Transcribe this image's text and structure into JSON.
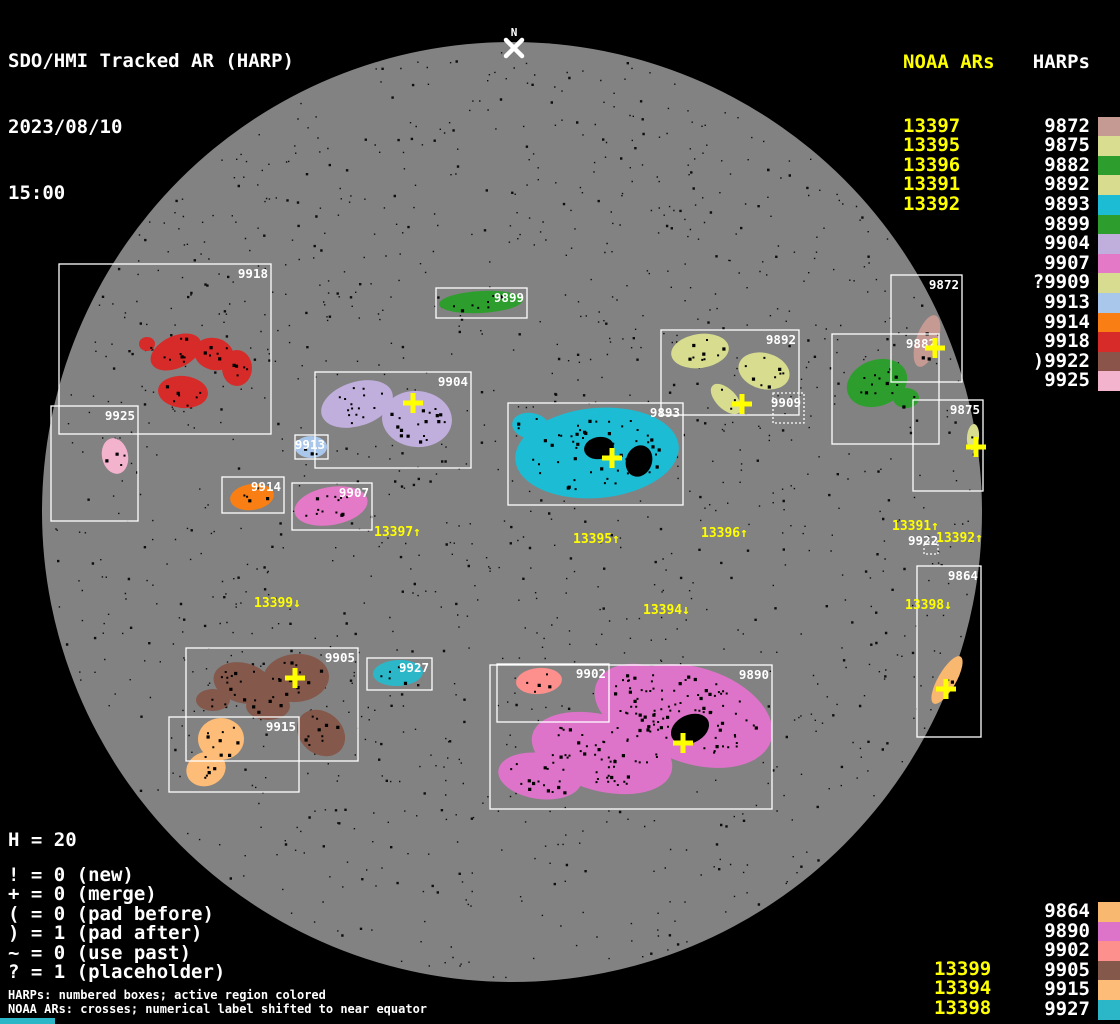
{
  "header": {
    "title": "SDO/HMI Tracked AR (HARP)",
    "date": "2023/08/10",
    "time": "15:00"
  },
  "north_marker": {
    "label": "N",
    "x": 514,
    "label_y": 36,
    "cross_x": 514,
    "cross_y": 48
  },
  "colors": {
    "background": "#000000",
    "disk": "#828282",
    "speckle": "#0d0d0d",
    "box_stroke": "#ffffff",
    "noaa_text": "#ffff00",
    "harp_text": "#ffffff",
    "cross": "#ffff00",
    "bottom_bar": "#2cb7c8"
  },
  "top_right": {
    "noaa_header": "NOAA ARs",
    "noaa_items": [
      "13397",
      "13395",
      "13396",
      "13391",
      "13392"
    ],
    "harps_header": "HARPs",
    "harp_items": [
      {
        "label": "9872",
        "color": "#c49a93"
      },
      {
        "label": "9875",
        "color": "#d9dd90"
      },
      {
        "label": "9882",
        "color": "#2d9e2d"
      },
      {
        "label": "9892",
        "color": "#d7dc8f"
      },
      {
        "label": "9893",
        "color": "#1cbcd4"
      },
      {
        "label": "9899",
        "color": "#2d9e2d"
      },
      {
        "label": "9904",
        "color": "#c0aedd"
      },
      {
        "label": "9907",
        "color": "#e379c7"
      },
      {
        "label": "?9909",
        "color": "#d8dc90"
      },
      {
        "label": "9913",
        "color": "#a9c7ea"
      },
      {
        "label": "9914",
        "color": "#f97f14"
      },
      {
        "label": "9918",
        "color": "#d62b28"
      },
      {
        "label": ")9922",
        "color": "#8b544a"
      },
      {
        "label": "9925",
        "color": "#f4b3cd"
      }
    ]
  },
  "bottom_right": {
    "noaa_items": [
      "13399",
      "13394",
      "13398"
    ],
    "harp_items": [
      {
        "label": "9864",
        "color": "#f9b870"
      },
      {
        "label": "9890",
        "color": "#dd74c9"
      },
      {
        "label": "9902",
        "color": "#fd8f8d"
      },
      {
        "label": "9905",
        "color": "#84584a"
      },
      {
        "label": "9915",
        "color": "#fdbc77"
      },
      {
        "label": "9927",
        "color": "#2cb7c8"
      }
    ]
  },
  "stats": {
    "h_count": "H = 20",
    "legend": [
      "! = 0 (new)",
      "+ = 0 (merge)",
      "( = 0 (pad before)",
      ") = 1 (pad after)",
      "~ = 0 (use past)",
      "? = 1 (placeholder)"
    ]
  },
  "footnotes": [
    "HARPs: numbered boxes; active region colored",
    "NOAA ARs: crosses; numerical label shifted to near equator"
  ],
  "chart_data": {
    "type": "solar-disk-map",
    "title": "SDO/HMI Tracked AR (HARP)",
    "timestamp": "2023/08/10 15:00",
    "disk": {
      "cx": 512,
      "cy": 512,
      "r": 470
    },
    "regions": [
      {
        "id": "9918",
        "color": "#d62b28",
        "box": [
          59,
          264,
          212,
          170
        ],
        "blobs": [
          [
            176,
            352,
            27,
            16,
            -25
          ],
          [
            214,
            354,
            20,
            16,
            15
          ],
          [
            237,
            368,
            15,
            18,
            0
          ],
          [
            183,
            392,
            25,
            16,
            5
          ],
          [
            147,
            344,
            8,
            7,
            0
          ]
        ]
      },
      {
        "id": "9925",
        "color": "#f4b3cd",
        "box": [
          51,
          406,
          87,
          115
        ],
        "blobs": [
          [
            115,
            456,
            13,
            18,
            -12
          ]
        ]
      },
      {
        "id": "9904",
        "color": "#c0aedd",
        "box": [
          315,
          372,
          156,
          96
        ],
        "blobs": [
          [
            357,
            404,
            37,
            22,
            -18
          ],
          [
            417,
            419,
            35,
            28,
            5
          ]
        ]
      },
      {
        "id": "9913",
        "color": "#a9c7ea",
        "box": [
          295,
          435,
          33,
          24
        ],
        "blobs": [
          [
            311,
            447,
            16,
            11,
            0
          ]
        ]
      },
      {
        "id": "9914",
        "color": "#f97f14",
        "box": [
          222,
          477,
          62,
          36
        ],
        "blobs": [
          [
            252,
            497,
            22,
            13,
            -8
          ]
        ]
      },
      {
        "id": "9907",
        "color": "#e379c7",
        "box": [
          292,
          483,
          80,
          47
        ],
        "blobs": [
          [
            331,
            506,
            37,
            19,
            -10
          ]
        ]
      },
      {
        "id": "9899",
        "color": "#2d9e2d",
        "box": [
          436,
          288,
          91,
          30
        ],
        "blobs": [
          [
            481,
            302,
            42,
            11,
            -3
          ]
        ]
      },
      {
        "id": "9893",
        "color": "#1cbcd4",
        "box": [
          508,
          403,
          175,
          102
        ],
        "blobs": [
          [
            597,
            453,
            82,
            45,
            -5
          ],
          [
            531,
            426,
            19,
            13,
            10
          ]
        ],
        "dark": [
          [
            599,
            448,
            15,
            11,
            -10
          ],
          [
            639,
            461,
            13,
            16,
            20
          ]
        ]
      },
      {
        "id": "9892",
        "color": "#d7dc8f",
        "box": [
          661,
          330,
          138,
          85
        ],
        "blobs": [
          [
            700,
            351,
            29,
            17,
            -8
          ],
          [
            764,
            371,
            26,
            18,
            15
          ],
          [
            726,
            399,
            19,
            10,
            45
          ]
        ]
      },
      {
        "id": "9909",
        "color": "#d8dc90",
        "box": [
          773,
          393,
          31,
          30
        ],
        "box_style": "dotted",
        "blobs": []
      },
      {
        "id": "9882",
        "color": "#2d9e2d",
        "box": [
          832,
          334,
          107,
          110
        ],
        "blobs": [
          [
            877,
            383,
            31,
            23,
            -20
          ],
          [
            906,
            398,
            13,
            10,
            0
          ]
        ]
      },
      {
        "id": "9872",
        "color": "#c49a93",
        "box": [
          891,
          275,
          71,
          107
        ],
        "blobs": [
          [
            927,
            341,
            11,
            27,
            18
          ]
        ]
      },
      {
        "id": "9875",
        "color": "#d9dd90",
        "box": [
          913,
          400,
          70,
          91
        ],
        "blobs": [
          [
            973,
            437,
            6,
            13,
            5
          ]
        ]
      },
      {
        "id": "9864",
        "color": "#f9b870",
        "box": [
          917,
          566,
          64,
          171
        ],
        "blobs": [
          [
            947,
            680,
            9,
            27,
            30
          ]
        ]
      },
      {
        "id": "9905",
        "color": "#84584a",
        "box": [
          186,
          648,
          172,
          113
        ],
        "blobs": [
          [
            243,
            683,
            30,
            20,
            15
          ],
          [
            296,
            678,
            33,
            24,
            -5
          ],
          [
            321,
            733,
            26,
            21,
            40
          ],
          [
            213,
            700,
            17,
            11,
            0
          ],
          [
            268,
            706,
            22,
            14,
            0
          ]
        ]
      },
      {
        "id": "9915",
        "color": "#fdbc77",
        "box": [
          169,
          717,
          130,
          75
        ],
        "blobs": [
          [
            221,
            739,
            23,
            21,
            0
          ],
          [
            206,
            769,
            20,
            17,
            -20
          ]
        ]
      },
      {
        "id": "9927",
        "color": "#2cb7c8",
        "box": [
          367,
          658,
          65,
          32
        ],
        "blobs": [
          [
            398,
            673,
            25,
            13,
            -3
          ]
        ]
      },
      {
        "id": "9902",
        "color": "#fd8f8d",
        "box": [
          497,
          664,
          112,
          58
        ],
        "blobs": [
          [
            539,
            681,
            23,
            13,
            -5
          ]
        ]
      },
      {
        "id": "9890",
        "color": "#dd74c9",
        "box": [
          490,
          665,
          282,
          144
        ],
        "blobs": [
          [
            695,
            716,
            80,
            48,
            18
          ],
          [
            602,
            753,
            72,
            38,
            15
          ],
          [
            540,
            776,
            42,
            23,
            8
          ],
          [
            645,
            702,
            52,
            36,
            20
          ]
        ],
        "dark": [
          [
            690,
            729,
            20,
            14,
            -25
          ]
        ]
      }
    ],
    "crosses": [
      {
        "x": 413,
        "y": 403
      },
      {
        "x": 742,
        "y": 404
      },
      {
        "x": 612,
        "y": 458
      },
      {
        "x": 935,
        "y": 348
      },
      {
        "x": 976,
        "y": 447
      },
      {
        "x": 946,
        "y": 689
      },
      {
        "x": 295,
        "y": 678
      },
      {
        "x": 683,
        "y": 743
      }
    ],
    "ar_labels": [
      {
        "text": "13397↑",
        "x": 374,
        "y": 536
      },
      {
        "text": "13395↑",
        "x": 573,
        "y": 543
      },
      {
        "text": "13396↑",
        "x": 701,
        "y": 537
      },
      {
        "text": "13391↑",
        "x": 892,
        "y": 530
      },
      {
        "text": "13392↑",
        "x": 936,
        "y": 542
      },
      {
        "text": "13399↓",
        "x": 254,
        "y": 607
      },
      {
        "text": "13394↓",
        "x": 643,
        "y": 614
      },
      {
        "text": "13398↓",
        "x": 905,
        "y": 609
      }
    ],
    "floating_labels": [
      {
        "text": "9922",
        "x": 908,
        "y": 545,
        "box": [
          924,
          542,
          14,
          12
        ]
      }
    ]
  }
}
